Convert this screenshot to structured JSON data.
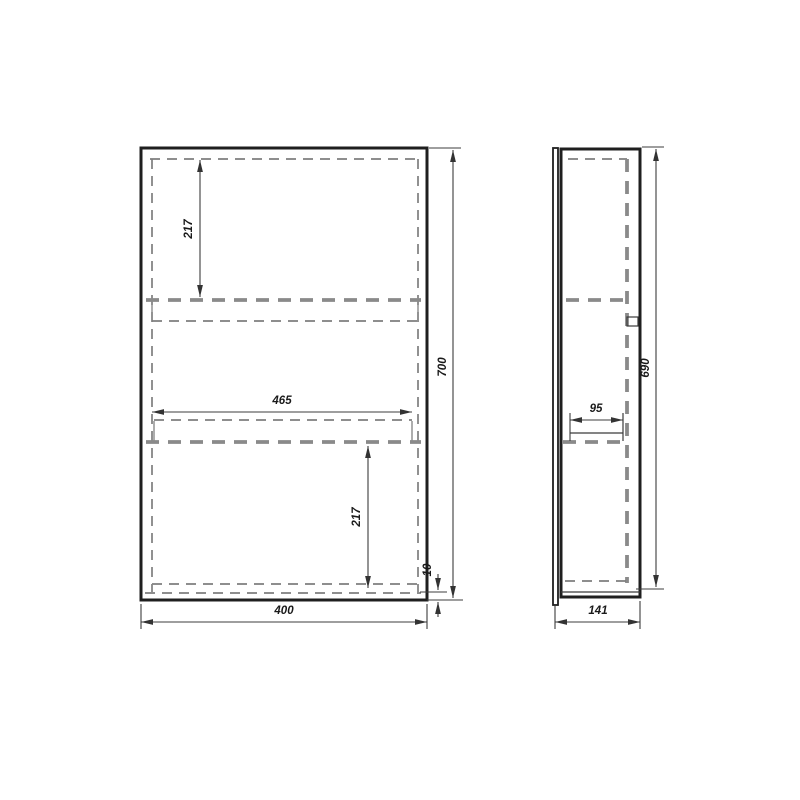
{
  "drawing": {
    "type": "technical-drawing",
    "subject": "wall-cabinet-two-views",
    "views": {
      "front": {
        "name": "front-view",
        "dimensions": {
          "overall_width": "400",
          "overall_height": "700",
          "shelf_width": "465",
          "upper_shelf_drop": "217",
          "lower_shelf_drop": "217",
          "bottom_panel_thickness": "10"
        }
      },
      "side": {
        "name": "side-view",
        "dimensions": {
          "overall_depth": "141",
          "inner_height": "690",
          "shelf_depth": "95"
        }
      }
    },
    "colors": {
      "outline": "#1f1f1f",
      "hidden_line": "#8a8a8a",
      "dimension_line": "#3c3c3c",
      "text": "#1a1a1a",
      "background": "#ffffff"
    }
  }
}
